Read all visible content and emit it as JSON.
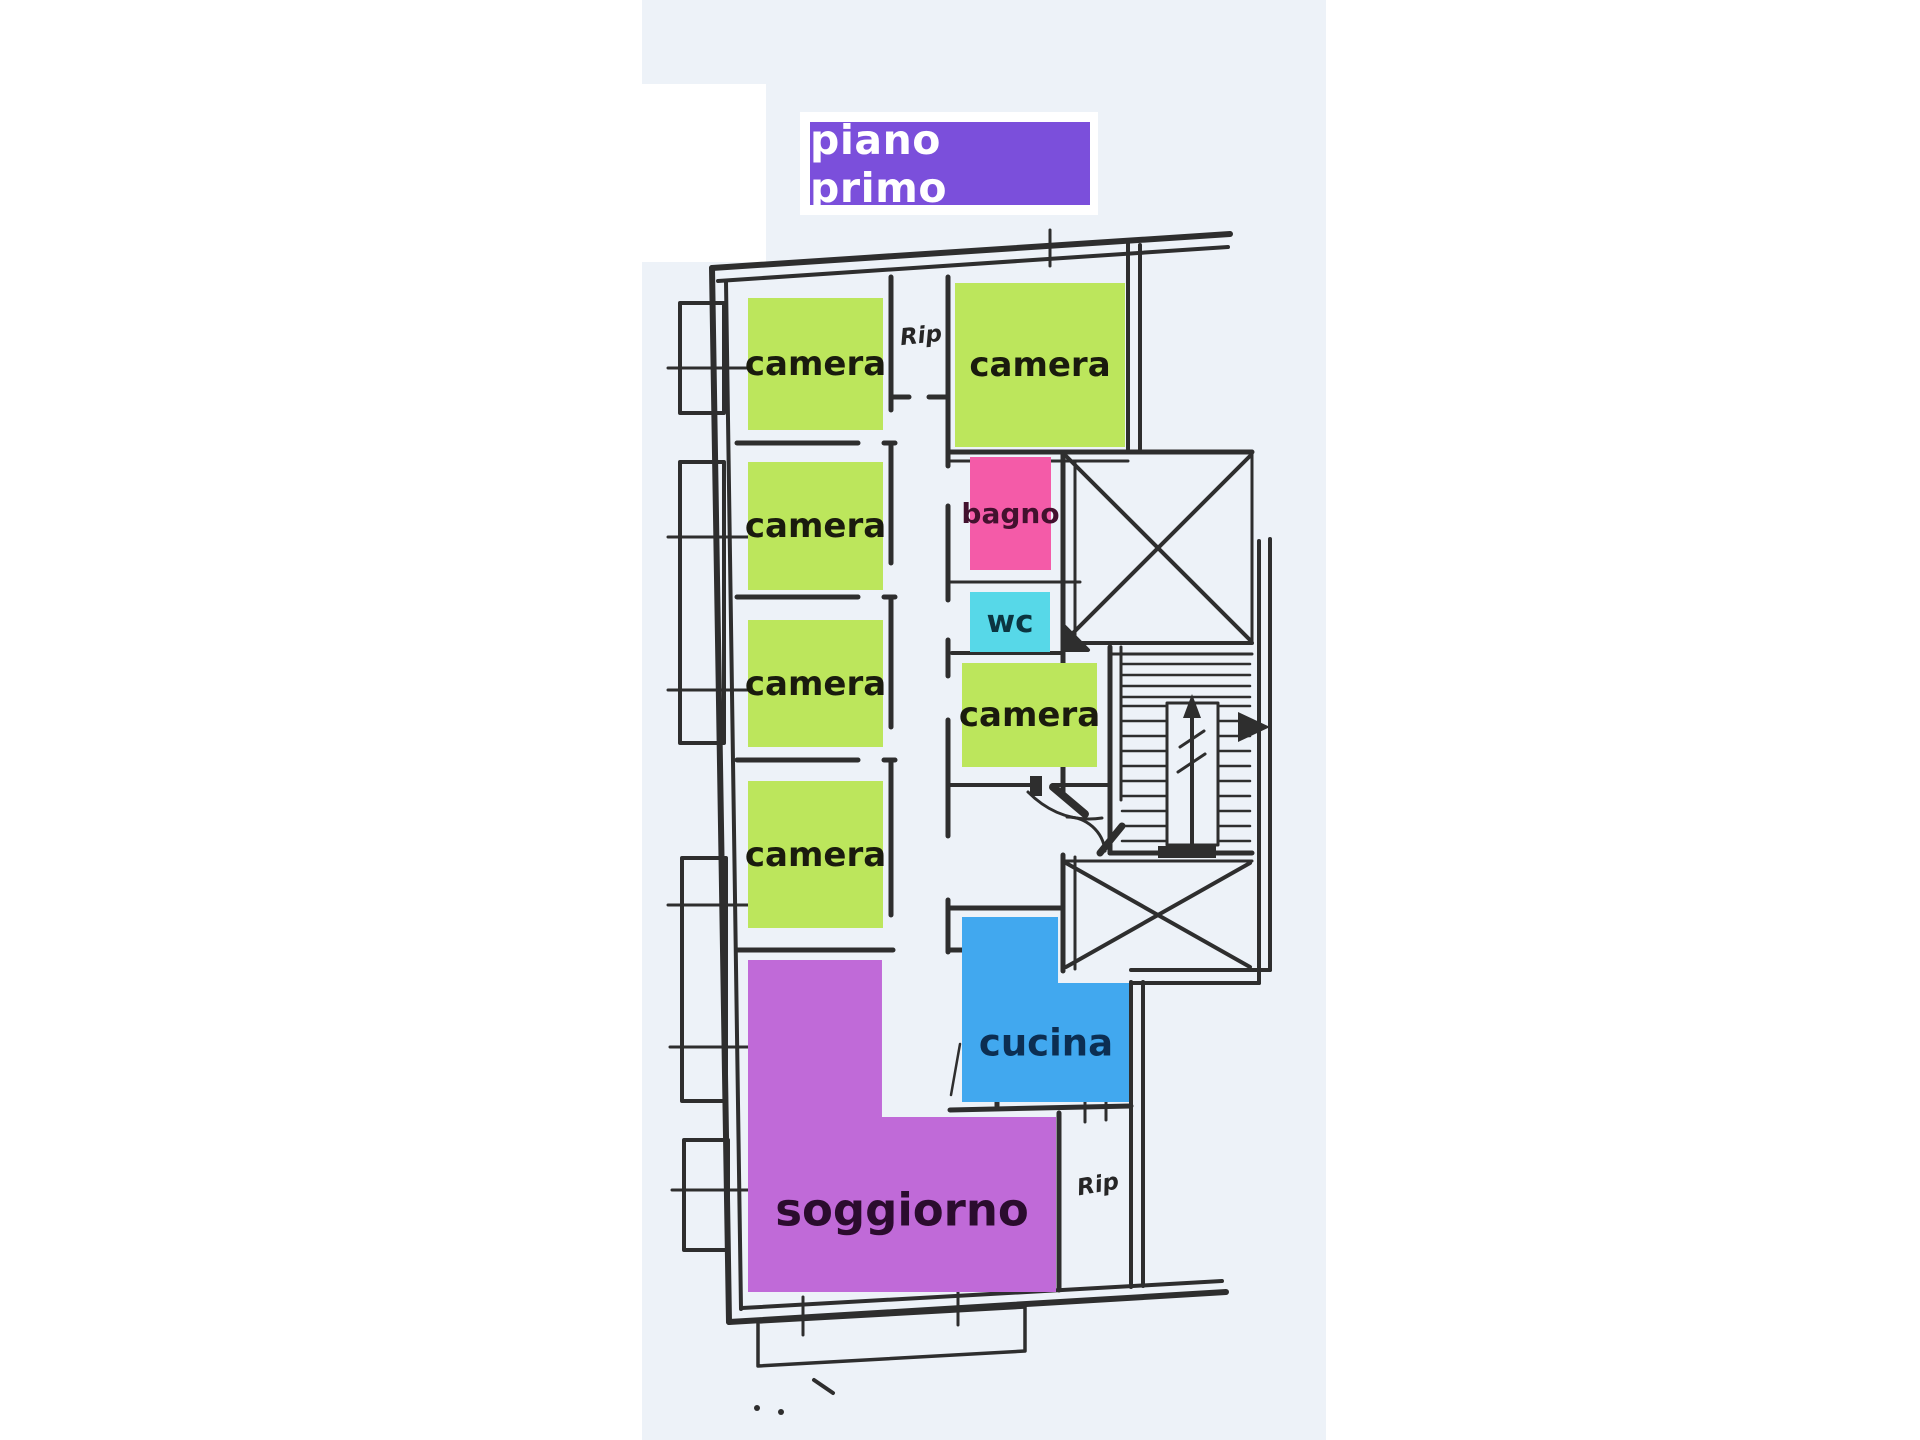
{
  "header": {
    "label": "piano primo",
    "bg": "#7b4fdb",
    "text": "#ffffff"
  },
  "rooms": {
    "camera1": {
      "label": "camera",
      "color": "#bce65c",
      "text": "#1a1b0e"
    },
    "camera2": {
      "label": "camera",
      "color": "#bce65c",
      "text": "#1a1b0e"
    },
    "camera3": {
      "label": "camera",
      "color": "#bce65c",
      "text": "#1a1b0e"
    },
    "camera4": {
      "label": "camera",
      "color": "#bce65c",
      "text": "#1a1b0e"
    },
    "cameraTop": {
      "label": "camera",
      "color": "#bce65c",
      "text": "#1a1b0e"
    },
    "camera5": {
      "label": "camera",
      "color": "#bce65c",
      "text": "#1a1b0e"
    },
    "bagno": {
      "label": "bagno",
      "color": "#f45ba8",
      "text": "#43112e"
    },
    "wc": {
      "label": "wc",
      "color": "#57d8e8",
      "text": "#0b3540"
    },
    "cucina": {
      "label": "cucina",
      "color": "#41a8ef",
      "text": "#0c2e52"
    },
    "soggiorno": {
      "label": "soggiorno",
      "color": "#c06ad8",
      "text": "#2b0c2e"
    }
  },
  "annotations": {
    "rip_upper": "Rip",
    "rip_lower": "Rip"
  },
  "canvas": {
    "wall_color": "#2e2e2e",
    "scan_bg": "#edf2f8",
    "page_bg": "#ffffff"
  }
}
